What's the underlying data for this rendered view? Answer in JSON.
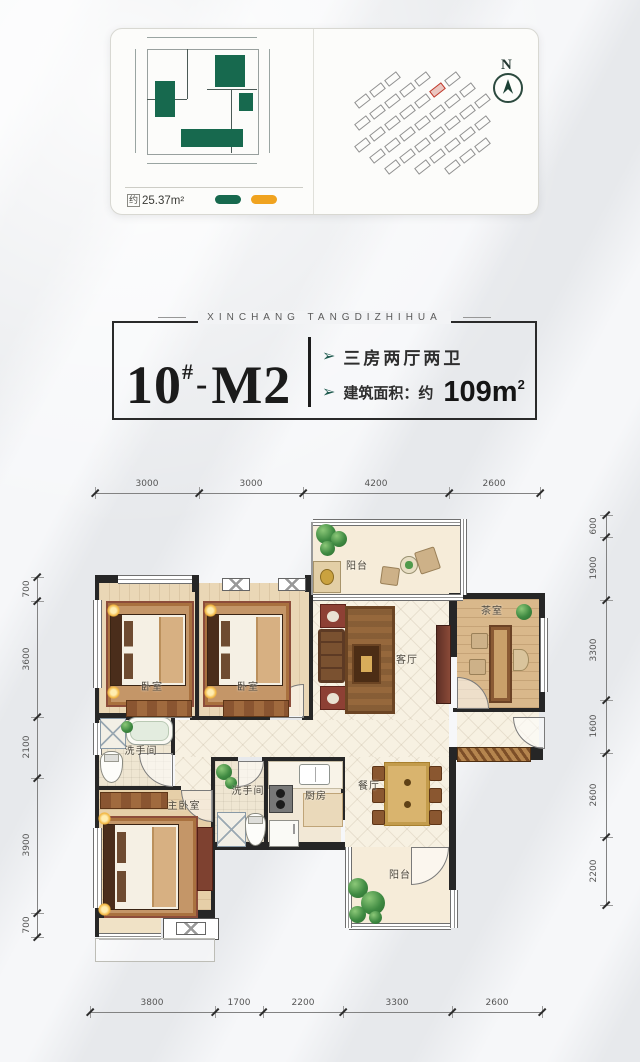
{
  "card": {
    "area_prefix": "约",
    "area_value": "25.37m²",
    "compass_label": "N"
  },
  "icons": {
    "feature_arrow": "➢"
  },
  "title": {
    "brand": "XINCHANG TANGDIZHIHUA",
    "unit_number": "10",
    "unit_hash": "#",
    "unit_dash": "-",
    "unit_model": "M2",
    "feature_rooms": "三房两厅两卫",
    "feature_area_prefix": "建筑面积：约",
    "feature_area_value": "109m",
    "feature_area_sup": "2"
  },
  "plan": {
    "rooms": {
      "balcony_top": "阳台",
      "bedroom_1": "卧室",
      "bedroom_2": "卧室",
      "tea_room": "茶室",
      "living": "客厅",
      "bath_1": "洗手间",
      "master": "主卧室",
      "bath_2": "洗手间",
      "kitchen": "厨房",
      "dining": "餐厅",
      "balcony_bottom": "阳台"
    },
    "dims": {
      "top": [
        "3000",
        "3000",
        "4200",
        "2600"
      ],
      "bottom": [
        "3800",
        "1700",
        "2200",
        "3300",
        "2600"
      ],
      "left": [
        "700",
        "3600",
        "2100",
        "3900",
        "700"
      ],
      "right": [
        "600",
        "1900",
        "3300",
        "1600",
        "2600",
        "2200"
      ]
    }
  },
  "colors": {
    "legend_green": "#17694e",
    "legend_orange": "#f0a31f",
    "arrow_teal": "#1e5a4e",
    "site_highlight": "#c0392b"
  }
}
